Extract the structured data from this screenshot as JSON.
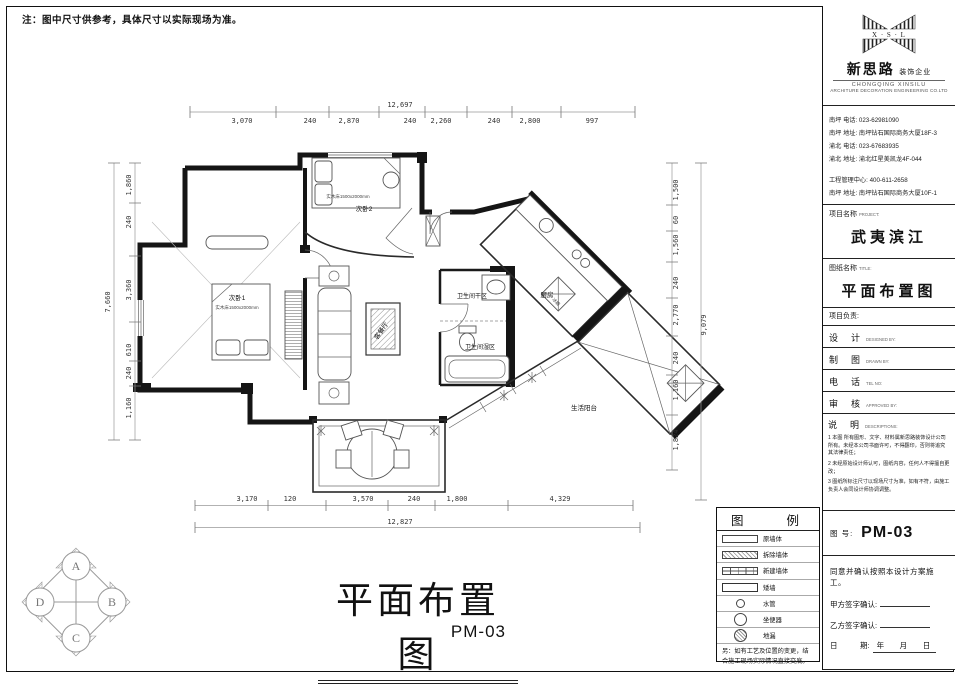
{
  "sheet_note": "注：图中尺寸供参考，具体尺寸以实际现场为准。",
  "logo": {
    "monogram": "X · S · L",
    "name_cn": "新思路",
    "name_suffix": "装饰企业",
    "name_en_line1": "CHONGQING  XINSILU",
    "name_en_line2": "ARCHITURE  DECORATION  ENGINEERING  CO.LTD"
  },
  "contacts": {
    "lines": [
      "南坪  电话: 023-62981090",
      "南坪  地址: 南坪钻石国际商务大厦18F-3",
      "渝北  电话: 023-67683935",
      "渝北  地址: 渝北红星美凯龙4F-044"
    ],
    "lines2": [
      "工程管理中心: 400-611-2658",
      "南坪  地址: 南坪钻石国际商务大厦10F-1"
    ]
  },
  "project": {
    "label": "项目名称",
    "label_en": "PROJECT:",
    "name": "武夷滨江"
  },
  "sheet": {
    "label": "图纸名称",
    "label_en": "TITLE:",
    "name": "平面布置图"
  },
  "leader_label": "项目负责:",
  "fields": [
    {
      "cn": "设　计",
      "en": "DESIGNED BY:"
    },
    {
      "cn": "制　图",
      "en": "DRAWN BY:"
    },
    {
      "cn": "电　话",
      "en": "TEL NO:"
    },
    {
      "cn": "审　核",
      "en": "APPROVED BY:"
    }
  ],
  "description": {
    "cn": "说　明",
    "en": "DESCRIPTIONS:",
    "notes": [
      "1 本图 所有图形、文字、材料属新思路装饰设计公司所有。未经本公司书面许可，不得翻印，否则将追究其法律责任；",
      "2 未经原始设计师认可，图纸内容，任何人不得擅自更改；",
      "3 图纸所标注尺寸以现场尺寸为准，如有不符，由施工负责人会同设计师协调调整。"
    ]
  },
  "drawing_no": {
    "label": "图 号:",
    "value": "PM-03"
  },
  "confirm": {
    "statement": "同意并确认按照本设计方案施工。",
    "party_a": "甲方签字确认:",
    "party_b": "乙方签字确认:",
    "date_label": "日　　　期:",
    "date_value": "年　 月　 日"
  },
  "legend": {
    "title": "图　　例",
    "items": [
      {
        "label": "原墙体"
      },
      {
        "label": "拆除墙体"
      },
      {
        "label": "新建墙体"
      },
      {
        "label": "矮墙"
      },
      {
        "label": "水管"
      },
      {
        "label": "坐便器"
      },
      {
        "label": "地漏"
      }
    ],
    "note": "另：如有工艺及位置的变更，结合施工现场实际情况直接交底。"
  },
  "main_title": {
    "text": "平面布置图",
    "code": "PM-03"
  },
  "compass": {
    "top": "A",
    "right": "B",
    "bottom": "C",
    "left": "D"
  },
  "plan": {
    "labels": {
      "bedroom1": "次卧1",
      "bedroom1_bed": "实木床1500x2000mm",
      "bedroom2": "次卧2",
      "bedroom2_bed": "实木床1500x2000mm",
      "living": "客餐厅",
      "bath_dry": "卫生间干区",
      "bath_wet": "卫生间湿区",
      "kitchen": "厨房",
      "fridge": "冰箱",
      "service_balcony": "生活阳台"
    },
    "dims": {
      "top": {
        "total": "12,697",
        "segments": [
          "3,070",
          "240",
          "2,870",
          "240",
          "2,260",
          "240",
          "2,800",
          "997"
        ]
      },
      "bottom": {
        "total": "12,827",
        "segments": [
          "3,170",
          "120",
          "3,570",
          "240",
          "1,800",
          "4,329"
        ]
      },
      "left": {
        "total": "7,660",
        "segments": [
          "1,860",
          "240",
          "3,360",
          "610",
          "240",
          "1,160"
        ]
      },
      "right": {
        "total": "9,079",
        "segments": [
          "1,500",
          "60",
          "1,560",
          "240",
          "2,770",
          "240",
          "1,160",
          "1,824"
        ]
      }
    }
  }
}
